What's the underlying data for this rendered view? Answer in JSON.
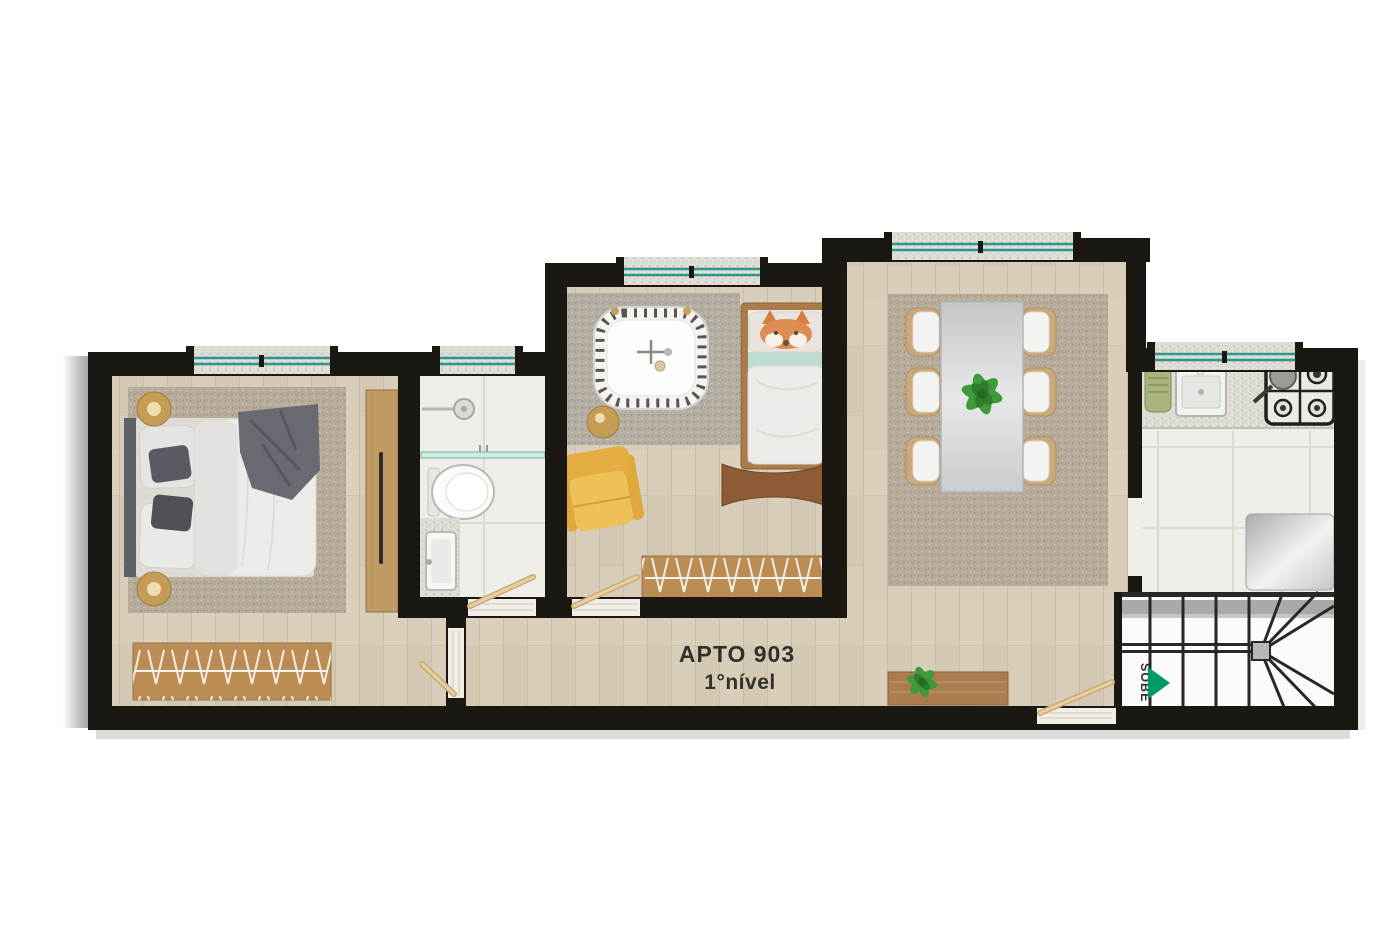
{
  "labels": {
    "unit": "APTO 903",
    "level": "1°nível",
    "stairs_direction": "SOBE"
  },
  "colors": {
    "wall": "#1b1713",
    "wood_floor": "#d8cdb8",
    "tile_floor": "#efede8",
    "granite": "#dfddd5",
    "rug_beige": "#b7ab9a",
    "rug_gray": "#b4aea3",
    "glass_teal": "#2f968d",
    "arrow_green": "#009b62",
    "armchair_yellow": "#eec158",
    "armchair_yellow_dark": "#dfa83c",
    "chair_tan": "#c9a87c",
    "furniture_wood": "#bb8d54",
    "dark_wood": "#8d5c34",
    "wardrobe_wood": "#bf9a63",
    "bedding_white": "#ecebe8",
    "blanket_gray": "#686c72",
    "fox_orange": "#dd8c52",
    "mint_blanket": "#bedcd0",
    "plant_green": "#3f9b3a",
    "plant_green_dark": "#2e7d2c",
    "gold": "#c59c55",
    "stair_line": "#2a2724",
    "stair_gray": "#a9a9a7",
    "label_ink": "#33302b",
    "door_wood": "#d9b98c",
    "shadow_gray": "#8c8c8c"
  }
}
